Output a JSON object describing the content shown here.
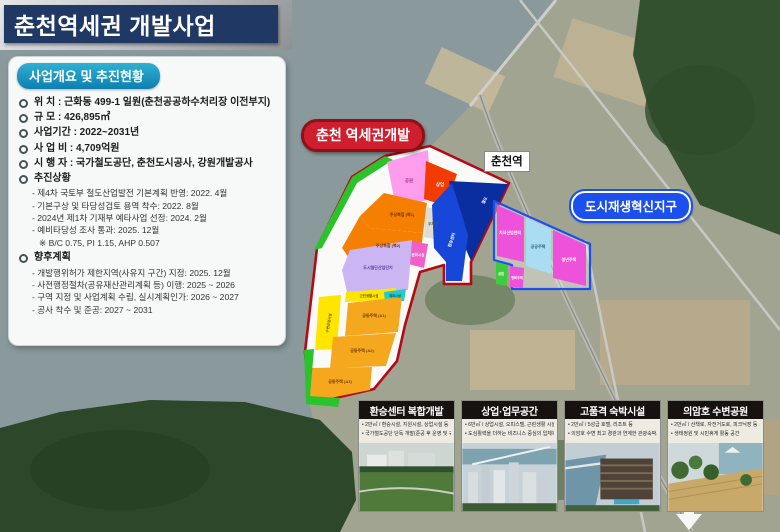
{
  "title": "춘천역세권 개발사업",
  "panel": {
    "header": "사업개요 및 추진현황",
    "items": [
      "위 치 : 근화동 499-1 일원(춘천공공하수처리장 이전부지)",
      "규 모 : 426,895㎡",
      "사업기간 : 2022~2031년",
      "사 업 비 : 4,709억원",
      "시 행 자 : 국가철도공단, 춘천도시공사, 강원개발공사"
    ],
    "progress": {
      "label": "추진상황",
      "items": [
        "- 제4차 국토부 철도산업발전 기본계획 반영: 2022. 4월",
        "- 기본구상 및 타당성검토 용역 착수: 2022. 8월",
        "- 2024년 제1차 기재부 예타사업 선정: 2024. 2월",
        "- 예비타당성 조사 통과: 2025. 12월",
        "※ B/C 0.75, PI 1.15, AHP 0.507"
      ]
    },
    "future": {
      "label": "향후계획",
      "items": [
        "- 개발행위허가 제한지역(사유지 구간) 지정: 2025. 12월",
        "- 사전행정절차(공유재산관리계획 등) 이행: 2025 ~ 2026",
        "- 구역 지정 및 사업계획 수립, 실시계획인가: 2026 ~ 2027",
        "- 공사 착수 및 준공: 2027 ~ 2031"
      ]
    }
  },
  "map": {
    "site_badge": "춘천 역세권개발",
    "station_label": "춘천역",
    "district_badge": "도시재생혁신지구",
    "colors": {
      "site_outline": "#b50914",
      "district_outline": "#1b50ee",
      "water": "#8a9a9c",
      "forest": "#2c4729"
    },
    "site_zones": [
      {
        "label": "공원",
        "color": "#ff9ded"
      },
      {
        "label": "상업",
        "color": "#f23b00"
      },
      {
        "label": "주상복합 (복1)",
        "color": "#f57f00"
      },
      {
        "label": "주상복합 (복2)",
        "color": "#f57f00"
      },
      {
        "label": "주차장",
        "color": "#dfddd3"
      },
      {
        "label": "문화시설",
        "color": "#f060c8"
      },
      {
        "label": "철도",
        "color": "#0a2da0"
      },
      {
        "label": "환승센터",
        "color": "#1747d8"
      },
      {
        "label": "도시첨단산업단지",
        "color": "#cbb5f2"
      },
      {
        "label": "근린생활시설",
        "color": "#ffe500"
      },
      {
        "label": "체육시설",
        "color": "#25c9c9"
      },
      {
        "label": "수변상업시설",
        "color": "#ffe500"
      },
      {
        "label": "공동주택 (A1)",
        "color": "#f5a81e"
      },
      {
        "label": "공동주택 (A2)",
        "color": "#f5a81e"
      },
      {
        "label": "공동주택 (A3)",
        "color": "#f5a81e"
      },
      {
        "label": "녹지",
        "color": "#2bc32b"
      }
    ],
    "district_zones": [
      {
        "label": "지식산업센터",
        "color": "#ef52da"
      },
      {
        "label": "공공주택",
        "color": "#aadcf2"
      },
      {
        "label": "청년주택",
        "color": "#ef52da"
      },
      {
        "label": "행복주택",
        "color": "#ef52da"
      },
      {
        "label": "공원",
        "color": "#3ecc3e"
      }
    ]
  },
  "cards": [
    {
      "title": "환승센터 복합개발",
      "bullets": [
        "• 2만㎡ / 환승시설, 지원시설, 상업시설 등",
        "• 국가철도공단 단독 개발(준공 후 운영 및 귀속)"
      ]
    },
    {
      "title": "상업·업무공간",
      "bullets": [
        "• 6만㎡ / 상업시설, 오피스텔, 근린생활 시설 등",
        "• 도심활력을 더하는 비즈니스 중심의 입체복합 공간"
      ]
    },
    {
      "title": "고품격 숙박시설",
      "bullets": [
        "• 2만㎡ / 5성급 호텔, 리조트 등",
        "• 의암호 수변 최고 경관과 연계한 관광숙박시설"
      ]
    },
    {
      "title": "의암호 수변공원",
      "bullets": [
        "• 2만㎡ / 산책로, 자전거도로, 피크닉장 등",
        "• 생태정원 및 시민휴게 활동 공간"
      ]
    }
  ]
}
